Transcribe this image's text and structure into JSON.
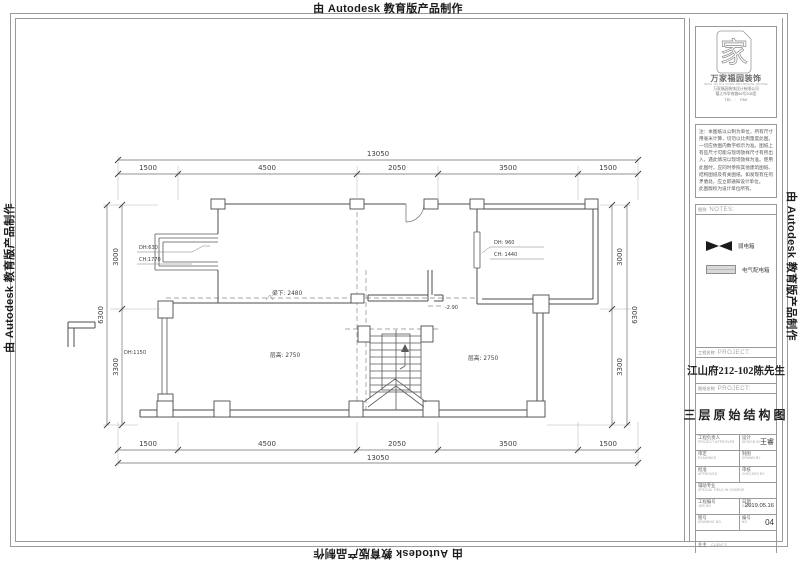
{
  "watermark": {
    "text": "由 Autodesk 教育版产品制作"
  },
  "plan": {
    "dims": {
      "h_total": "13050",
      "h_segments": [
        "1500",
        "4500",
        "2050",
        "3500",
        "1500"
      ],
      "v_total": "6300",
      "v_segments": [
        "3000",
        "3300"
      ]
    },
    "labels": {
      "bay_dh": "DH:630",
      "bay_ch": "CH:1770",
      "win_right_dh": "DH: 960",
      "win_right_ch": "CH: 1440",
      "win_left_dh": "DH:1150",
      "beam": "梁下: 2480",
      "height_left": "层高: 2750",
      "height_right": "层高: 2750",
      "level": "-2.90"
    }
  },
  "titleblock": {
    "logo": {
      "glyph": "家",
      "wordmark": "万家福园装饰",
      "subtitle": "WAN JIA FU YUAN DECORATE HOUSE",
      "company": "万家福园装饰设计有限公司",
      "address": "镇江市学府路66号208室",
      "phone": "TEL　·　FAX"
    },
    "notes": {
      "text": "注：本图纸以公制为单位，所有尺寸用毫米计算，切勿以比例量度此图。一切应依图内数字标示为准。图纸上有些尺寸可能与现场放样尺寸有所出入，遇此情况以现场放样为准。使用此图时，应同时参照其他建筑图纸、结构图纸及有关图纸，如发现有任何矛盾处，应立即通知设计单位。\n此图版权为设计单位所有。"
    },
    "legend": {
      "header_cn": "图例",
      "header_en": "NOTES:",
      "items": [
        {
          "label": "弱电箱"
        },
        {
          "label": "电气配电箱"
        }
      ]
    },
    "project": {
      "header_cn": "工程名称",
      "header_en": "PROJECT:",
      "value": "江山府212-102陈先生"
    },
    "drawing": {
      "header_cn": "图纸名称",
      "header_en": "PROJECT:",
      "value": "三层原始结构图"
    },
    "table": {
      "rows": [
        {
          "l_cn": "工程负责人",
          "l_en": "PROJECT APPROVER",
          "r_cn": "设计",
          "r_en": "DESIGN BY",
          "r_val": "王睿"
        },
        {
          "l_cn": "审定",
          "l_en": "EXAMINED",
          "r_cn": "制图",
          "r_en": "DRAWN BY",
          "r_val": ""
        },
        {
          "l_cn": "批准",
          "l_en": "APPROVED",
          "r_cn": "审核",
          "r_en": "CHECKED BY",
          "r_val": ""
        },
        {
          "l_cn": "辅助专业",
          "l_en": "SPECIAL FIELD IN CHARGE",
          "r_cn": "",
          "r_en": "",
          "r_val": ""
        },
        {
          "l_cn": "工程编号",
          "l_en": "JOB NO.",
          "r_cn": "日期",
          "r_en": "DATE",
          "r_val": "2019.05.16"
        },
        {
          "l_cn": "图号",
          "l_en": "DRAWING NO.",
          "r_cn": "编号",
          "r_en": "NO.",
          "r_val": "04"
        }
      ],
      "client": {
        "cn": "业主",
        "en": "CLIENT'S"
      }
    }
  }
}
